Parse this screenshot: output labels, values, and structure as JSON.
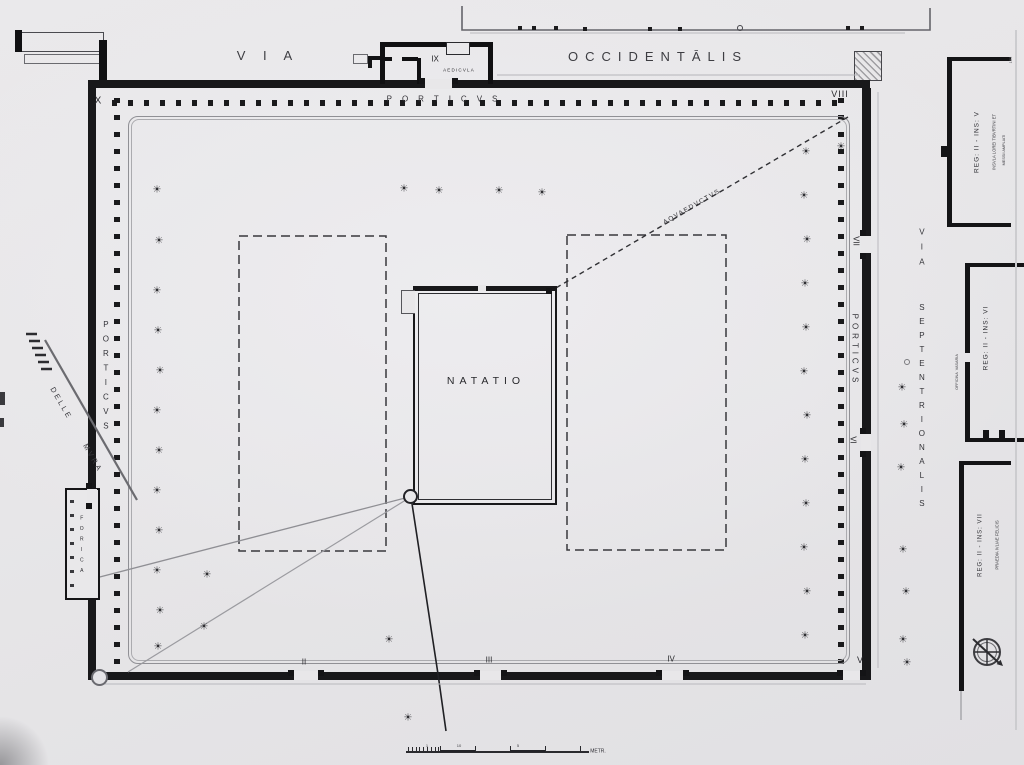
{
  "plan": {
    "pool_label": "NATATIO",
    "streets": {
      "top_street": [
        "VIA",
        "OCCIDENTĀLIS"
      ],
      "right_street": [
        "VIA",
        "SEPTENTRIONALIS"
      ]
    },
    "porticoes": [
      "PORTICVS",
      "PORTICVS",
      "PORTICVS"
    ],
    "gate_numbers": [
      "II",
      "III",
      "IV",
      "V",
      "VI",
      "VII",
      "VIII",
      "IX",
      "X"
    ],
    "features": [
      "AEDICVLA",
      "AQVAEDVCTVS",
      "FORICA",
      "DELLE MVRA"
    ],
    "margin_designations": [
      "INSVLA LOREI TIBVRTINI ET",
      "MESSII AMPLIATI",
      "REG: II - INS: V",
      "REG: II - INS: VI",
      "OFFICINA VASARIA",
      "PRAEDIA IVLIAE FELICIS",
      "REG: II - INS: VII"
    ],
    "scale_unit": "METR."
  },
  "colors": {
    "paper": "#e8e7e9",
    "ink": "#18181a",
    "gray_line": "#909095",
    "dash": "#38383c"
  },
  "labels": [
    {
      "name": "street-label-via-west",
      "text": "V I A",
      "x": 268,
      "y": 56,
      "fs": 13,
      "ls": 7,
      "col": "#3d3d42"
    },
    {
      "name": "street-label-occidentalis",
      "text": "OCCIDENTĀLIS",
      "x": 658,
      "y": 57,
      "fs": 13,
      "ls": 7,
      "col": "#3d3d42"
    },
    {
      "name": "porticus-north-label",
      "text": "PORTICVS",
      "x": 447,
      "y": 100,
      "fs": 8,
      "ls": 10,
      "col": "#333338"
    },
    {
      "name": "gate-ix-label",
      "text": "IX",
      "x": 435,
      "y": 60,
      "fs": 8,
      "col": "#222226"
    },
    {
      "name": "aedicula-label",
      "text": "AEDICVLA",
      "x": 459,
      "y": 71,
      "fs": 4.5,
      "ls": 1.2,
      "col": "#2c2c30"
    },
    {
      "name": "corner-x-label",
      "text": "X",
      "x": 98,
      "y": 101,
      "fs": 10,
      "col": "#28282c"
    },
    {
      "name": "corner-viii-label",
      "text": "VIII",
      "x": 840,
      "y": 95,
      "fs": 9,
      "ls": 1,
      "col": "#28282c"
    },
    {
      "name": "aqueduct-label",
      "text": "AQVAEDVCTVS",
      "x": 692,
      "y": 207,
      "fs": 6.5,
      "ls": 1.5,
      "rot": -30,
      "col": "#2c2c30"
    },
    {
      "name": "natatio-label",
      "text": "NATATIO",
      "x": 486,
      "y": 382,
      "fs": 10.5,
      "ls": 5,
      "col": "#28282c"
    },
    {
      "name": "porticus-west-label",
      "text": "PORTICVS",
      "x": 105,
      "y": 378,
      "fs": 8,
      "ls": 5.5,
      "mode": "stack",
      "col": "#333338"
    },
    {
      "name": "delle-mura-label",
      "text": "DELLE  MVRA",
      "x": 76,
      "y": 430,
      "fs": 7.5,
      "ls": 2.5,
      "ws": 10,
      "rot": 60,
      "col": "#3a3a3f"
    },
    {
      "name": "forica-label",
      "text": "FORICA",
      "x": 81,
      "y": 547,
      "fs": 5,
      "ls": 4.5,
      "mode": "stack",
      "col": "#2c2c30"
    },
    {
      "name": "porticus-east-label",
      "text": "PORTICVS",
      "x": 854,
      "y": 350,
      "fs": 8,
      "ls": 4,
      "mode": "vert",
      "col": "#333338"
    },
    {
      "name": "gate-vii-label",
      "text": "VII",
      "x": 855,
      "y": 241,
      "fs": 8,
      "rot": 90,
      "col": "#28282c"
    },
    {
      "name": "gate-vi-label",
      "text": "VI",
      "x": 852,
      "y": 440,
      "fs": 8,
      "rot": 90,
      "col": "#28282c"
    },
    {
      "name": "gate-v-label",
      "text": "V",
      "x": 860,
      "y": 661,
      "fs": 9,
      "col": "#28282c"
    },
    {
      "name": "gate-ii-label",
      "text": "II",
      "x": 304,
      "y": 663,
      "fs": 8,
      "col": "#28282c"
    },
    {
      "name": "gate-iii-label",
      "text": "III",
      "x": 489,
      "y": 661,
      "fs": 8,
      "col": "#28282c"
    },
    {
      "name": "gate-iv-label",
      "text": "IV",
      "x": 671,
      "y": 660,
      "fs": 8,
      "col": "#28282c"
    },
    {
      "name": "street-label-via-north",
      "text": "VIA",
      "x": 921,
      "y": 250,
      "fs": 8,
      "ls": 6,
      "mode": "stack",
      "col": "#333338"
    },
    {
      "name": "street-label-septentrionalis",
      "text": "SEPTENTRIONALIS",
      "x": 921,
      "y": 408,
      "fs": 8,
      "ls": 5,
      "mode": "stack",
      "col": "#333338"
    },
    {
      "name": "reg-ii-ins-v-label",
      "text": "REG: II - INS: V",
      "x": 977,
      "y": 142,
      "fs": 6.5,
      "ls": 1,
      "rot": -90,
      "col": "#2e2e33"
    },
    {
      "name": "insula-lorei-label",
      "text": "INSVLA LOREI TIBVRTINI ET",
      "x": 995,
      "y": 142,
      "fs": 4.2,
      "rot": -90,
      "col": "#3a3a3f"
    },
    {
      "name": "messii-ampliati-label",
      "text": "MESSII AMPLIATI",
      "x": 1004,
      "y": 150,
      "fs": 3.8,
      "rot": -90,
      "col": "#45454a"
    },
    {
      "name": "reg-ii-ins-vi-label",
      "text": "REG: II - INS: VI",
      "x": 986,
      "y": 338,
      "fs": 6.5,
      "ls": 1,
      "rot": -90,
      "col": "#2e2e33"
    },
    {
      "name": "officina-vasaria-label",
      "text": "OFFICINA  VASARIA",
      "x": 957,
      "y": 372,
      "fs": 3.8,
      "rot": -90,
      "col": "#45454a"
    },
    {
      "name": "reg-ii-ins-vii-label",
      "text": "REG: II - INS: VII",
      "x": 981,
      "y": 545,
      "fs": 6,
      "ls": 1,
      "rot": -90,
      "col": "#2e2e33"
    },
    {
      "name": "praedia-iuliae-label",
      "text": "PRAEDIA IVLIAE FELICIS",
      "x": 998,
      "y": 545,
      "fs": 4.2,
      "rot": -90,
      "col": "#3a3a3f"
    },
    {
      "name": "scale-unit-label",
      "text": "METR.",
      "x": 598,
      "y": 752,
      "fs": 5,
      "col": "#2e2e33"
    },
    {
      "name": "scale-number-1",
      "text": "1",
      "x": 427,
      "y": 746,
      "fs": 4,
      "col": "#3a3a3f"
    },
    {
      "name": "scale-number-10",
      "text": "10",
      "x": 459,
      "y": 746,
      "fs": 4,
      "col": "#3a3a3f"
    },
    {
      "name": "scale-number-5",
      "text": "5",
      "x": 518,
      "y": 746,
      "fs": 4,
      "col": "#3a3a3f"
    },
    {
      "name": "plate-number",
      "text": "183",
      "x": 1011,
      "y": 60,
      "fs": 4,
      "rot": -90,
      "col": "#6a6a6e"
    }
  ],
  "trees": {
    "symbol": "☀",
    "positions": [
      [
        157,
        190
      ],
      [
        159,
        241
      ],
      [
        157,
        291
      ],
      [
        158,
        331
      ],
      [
        160,
        371
      ],
      [
        157,
        411
      ],
      [
        159,
        451
      ],
      [
        157,
        491
      ],
      [
        159,
        531
      ],
      [
        157,
        571
      ],
      [
        160,
        611
      ],
      [
        158,
        647
      ],
      [
        207,
        575
      ],
      [
        204,
        627
      ],
      [
        404,
        189
      ],
      [
        439,
        191
      ],
      [
        499,
        191
      ],
      [
        542,
        193
      ],
      [
        806,
        152
      ],
      [
        804,
        196
      ],
      [
        807,
        240
      ],
      [
        805,
        284
      ],
      [
        806,
        328
      ],
      [
        804,
        372
      ],
      [
        807,
        416
      ],
      [
        805,
        460
      ],
      [
        806,
        504
      ],
      [
        804,
        548
      ],
      [
        807,
        592
      ],
      [
        805,
        636
      ],
      [
        902,
        388
      ],
      [
        904,
        425
      ],
      [
        901,
        468
      ],
      [
        903,
        550
      ],
      [
        906,
        592
      ],
      [
        903,
        640
      ],
      [
        907,
        663
      ],
      [
        389,
        640
      ],
      [
        408,
        718
      ],
      [
        841,
        147
      ]
    ]
  },
  "gates": [
    {
      "name": "gate-ii",
      "x": 294,
      "y": 671,
      "w": 24,
      "h": 9,
      "o": "h"
    },
    {
      "name": "gate-iii",
      "x": 480,
      "y": 671,
      "w": 21,
      "h": 9,
      "o": "h"
    },
    {
      "name": "gate-iv",
      "x": 662,
      "y": 671,
      "w": 21,
      "h": 9,
      "o": "h"
    },
    {
      "name": "gate-v",
      "x": 843,
      "y": 671,
      "w": 17,
      "h": 9,
      "o": "h"
    },
    {
      "name": "gate-vii",
      "x": 861,
      "y": 236,
      "w": 10,
      "h": 17,
      "o": "v"
    },
    {
      "name": "gate-vi",
      "x": 861,
      "y": 434,
      "w": 10,
      "h": 17,
      "o": "v"
    },
    {
      "name": "forica-door",
      "x": 87,
      "y": 489,
      "w": 10,
      "h": 14,
      "o": "v"
    },
    {
      "name": "gate-ix",
      "x": 425,
      "y": 79,
      "w": 27,
      "h": 10,
      "o": "h"
    }
  ],
  "street_piers": [
    [
      518,
      26
    ],
    [
      532,
      26
    ],
    [
      554,
      26
    ],
    [
      583,
      27
    ],
    [
      648,
      27
    ],
    [
      678,
      27
    ],
    [
      846,
      26
    ],
    [
      860,
      26
    ]
  ],
  "scalebar": {
    "x": 406,
    "y": 751,
    "width": 183,
    "fine_ticks_from": 408,
    "fine_ticks_to": 440,
    "major_ticks": [
      440,
      475,
      510,
      545,
      580
    ],
    "blocks": [
      [
        440,
        35
      ],
      [
        510,
        35
      ]
    ]
  }
}
